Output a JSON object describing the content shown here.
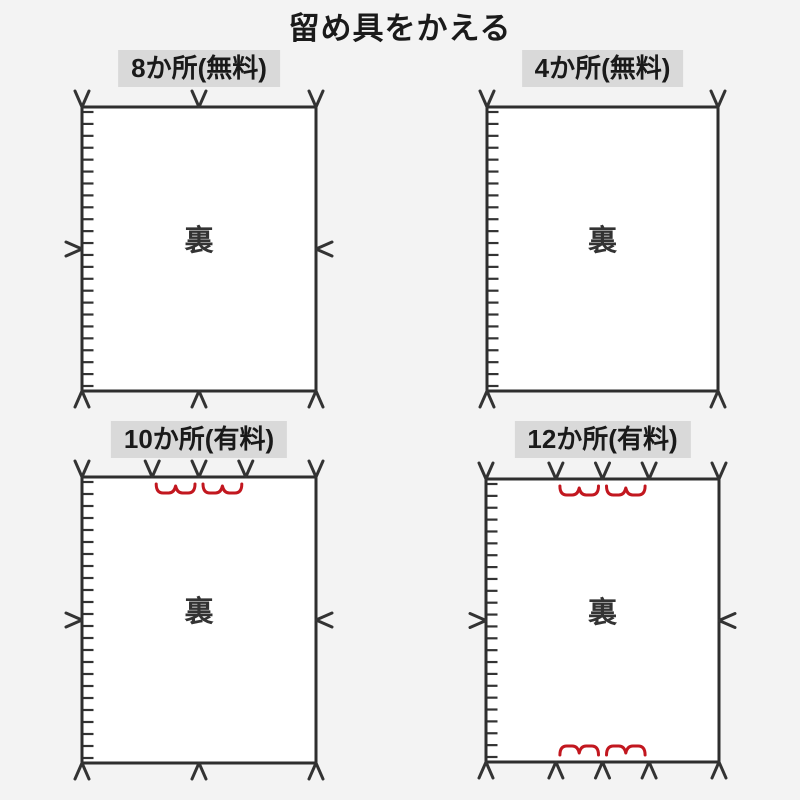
{
  "page": {
    "title": "留め具をかえる",
    "colors": {
      "background": "#f3f3f3",
      "header_bg": "#d9d9d9",
      "ink": "#333333",
      "outline": "#2e2e2e",
      "accent_red": "#c2171f",
      "panel_fill": "#ffffff"
    }
  },
  "panels": [
    {
      "id": "8-places-free",
      "label": "8か所(無料)",
      "back_label": "裏",
      "clips": {
        "top": [
          "left",
          "center",
          "right"
        ],
        "bottom": [
          "left",
          "center",
          "right"
        ],
        "left": [
          "middle"
        ],
        "right": [
          "middle"
        ]
      },
      "measures": []
    },
    {
      "id": "4-places-free",
      "label": "4か所(無料)",
      "back_label": "裏",
      "clips": {
        "top": [
          "left",
          "right"
        ],
        "bottom": [
          "left",
          "right"
        ],
        "left": [],
        "right": []
      },
      "measures": []
    },
    {
      "id": "10-places-paid",
      "label": "10か所(有料)",
      "back_label": "裏",
      "clips": {
        "top": [
          "left",
          "center-left",
          "center",
          "center-right",
          "right"
        ],
        "bottom": [
          "left",
          "center",
          "right"
        ],
        "left": [
          "middle"
        ],
        "right": [
          "middle"
        ]
      },
      "measures": [
        {
          "edge": "top",
          "labels": [
            "25cm",
            "25cm"
          ]
        }
      ]
    },
    {
      "id": "12-places-paid",
      "label": "12か所(有料)",
      "back_label": "裏",
      "clips": {
        "top": [
          "left",
          "center-left",
          "center",
          "center-right",
          "right"
        ],
        "bottom": [
          "left",
          "center-left",
          "center",
          "center-right",
          "right"
        ],
        "left": [
          "middle"
        ],
        "right": [
          "middle"
        ]
      },
      "measures": [
        {
          "edge": "top",
          "labels": [
            "25cm",
            "25cm"
          ]
        },
        {
          "edge": "bottom",
          "labels": [
            "25cm",
            "25cm"
          ]
        }
      ]
    }
  ]
}
